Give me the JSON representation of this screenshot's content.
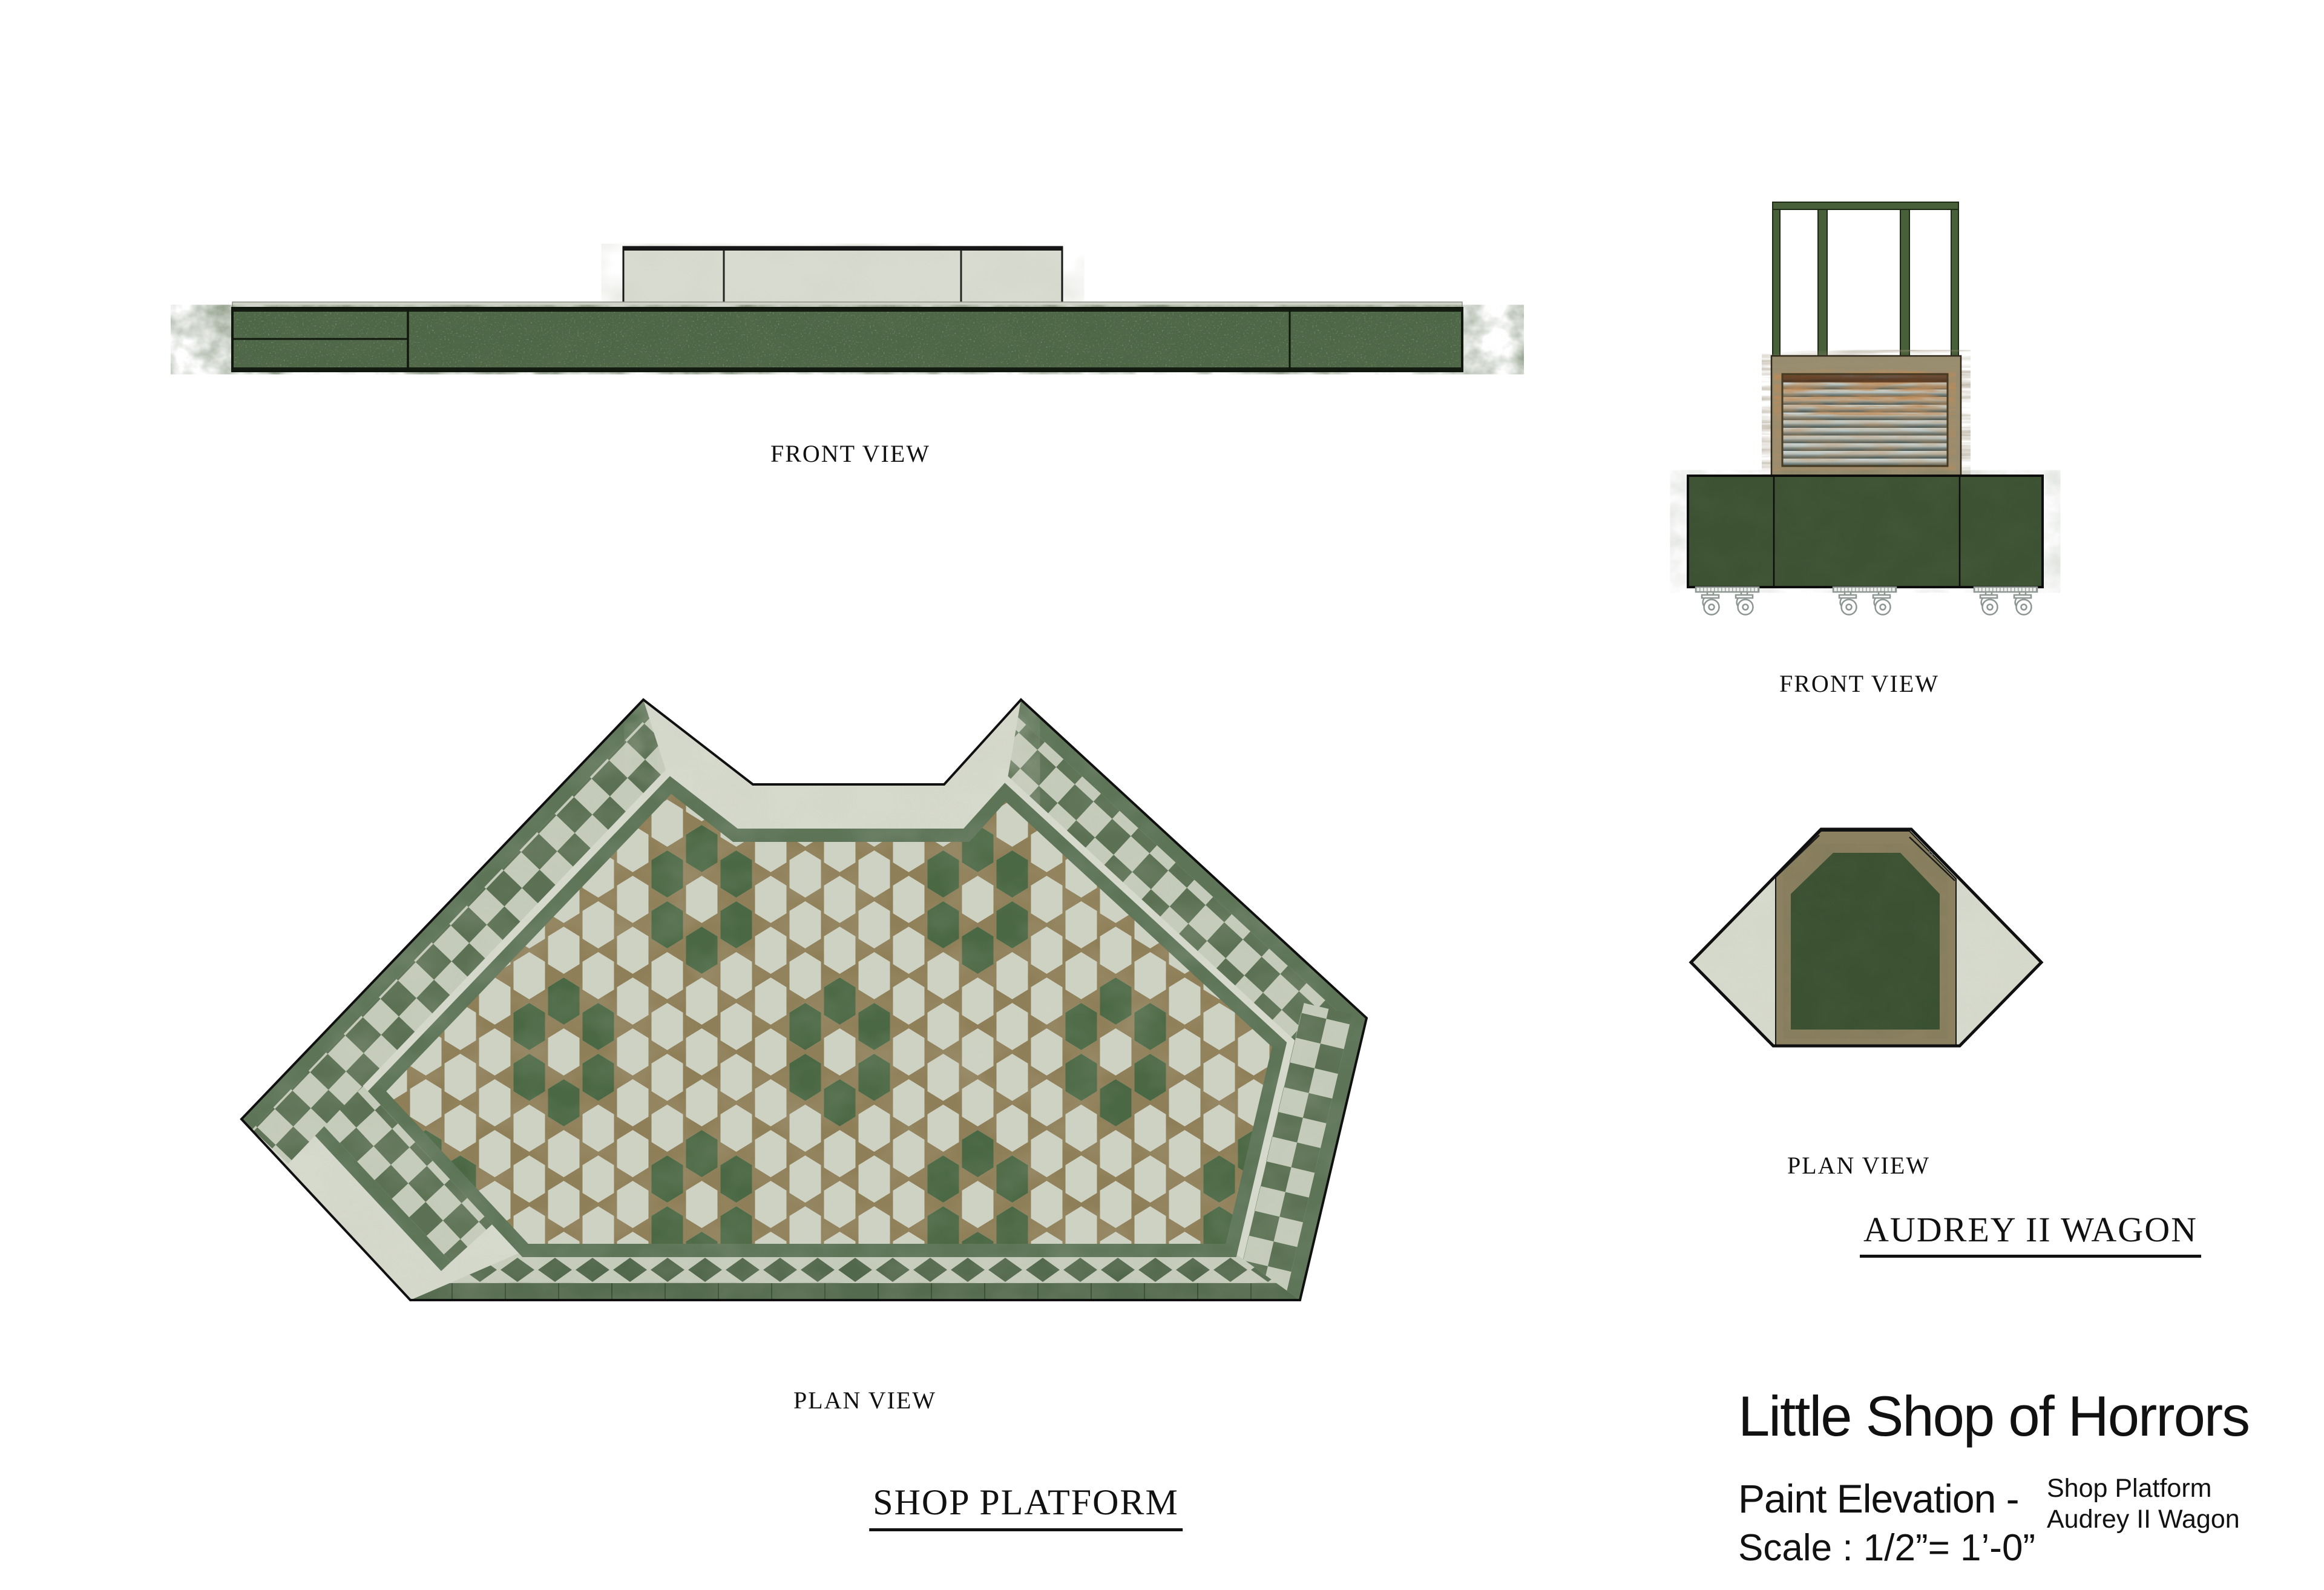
{
  "sheet": {
    "background": "#ffffff"
  },
  "labels": {
    "platform_front": "FRONT VIEW",
    "platform_plan": "PLAN VIEW",
    "wagon_front": "FRONT VIEW",
    "wagon_plan": "PLAN VIEW"
  },
  "titles": {
    "platform": "SHOP PLATFORM",
    "wagon": "AUDREY II WAGON"
  },
  "title_block": {
    "show": "Little Shop of Horrors",
    "sheet_type": "Paint Elevation -",
    "subject_line1": "Shop Platform",
    "subject_line2": "Audrey II Wagon",
    "scale": "Scale : 1/2”= 1’-0”"
  },
  "colors": {
    "ink": "#111111",
    "outline": "#101010",
    "marble_light": "#d6dacc",
    "marble_vein": "#a9b19d",
    "grout": "#8f7f58",
    "tile_light": "#cdd2c3",
    "tile_green": "#4b6844",
    "checker_green": "#5c7154",
    "checker_light": "#c5cbba",
    "band_green": "#5d7457",
    "brick_green": "#566c50",
    "diamond_green": "#52684c",
    "slab_green": "#4d6747",
    "slab_edge": "#141b10",
    "step_marble": "#d8dcd0",
    "wagon_base_green": "#3c5233",
    "wagon_frame_green": "#47603a",
    "wood": "#9a8e70",
    "wood_dark": "#5f5440",
    "metal_light": "#c2ccc8",
    "rust": "#8c4a1e",
    "rust_dark": "#46240e",
    "olive": "#8b8060",
    "wagon_plan_green": "#3b5132",
    "caster_gray": "#8e9692"
  }
}
